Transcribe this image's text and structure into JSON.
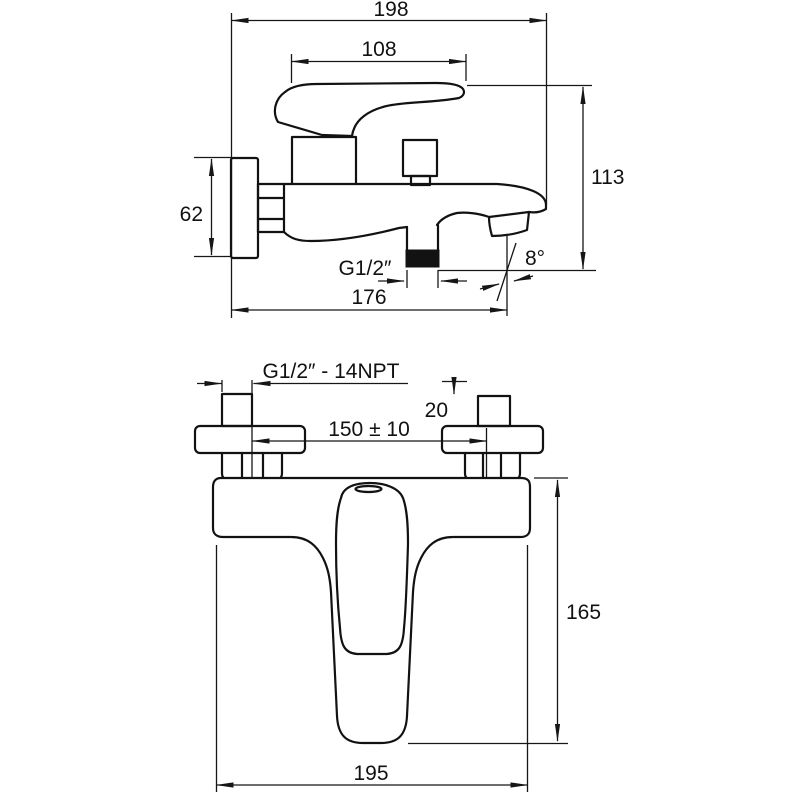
{
  "drawing": {
    "background": "#ffffff",
    "ink": "#121212",
    "side_view": {
      "overall_length": "198",
      "handle_length": "108",
      "overall_height": "113",
      "plate_height": "62",
      "wall_to_outlet": "176",
      "outlet_thread": "G1/2″",
      "spout_angle": "8°"
    },
    "front_view": {
      "connection_thread": "G1/2″ - 14NPT",
      "stub_height": "20",
      "connection_spacing": "150 ± 10",
      "spout_reach": "165",
      "body_width": "195"
    }
  }
}
